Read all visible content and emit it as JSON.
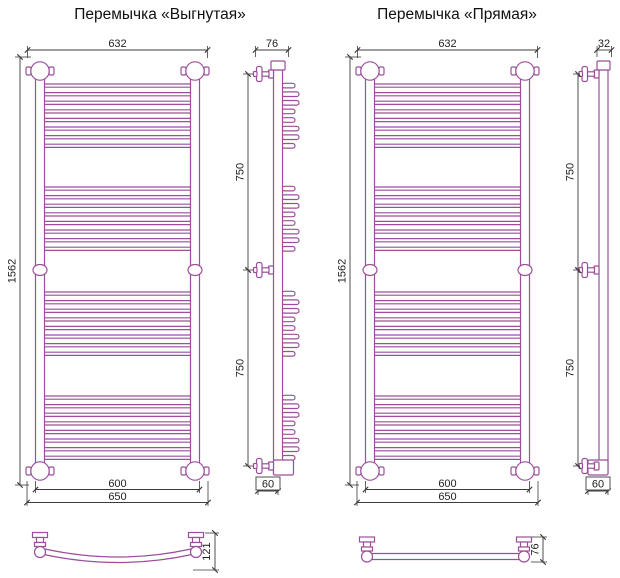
{
  "colors": {
    "product_line": "#9B4F9B",
    "dimension_line": "#3C3C3C",
    "text": "#222222"
  },
  "views": {
    "curved": {
      "title": "Перемычка «Выгнутая»",
      "front": {
        "width_top": "632",
        "height": "1562",
        "mount_span": "600",
        "overall_width": "650"
      },
      "side": {
        "depth_top": "76",
        "upper_span": "750",
        "lower_span": "750",
        "bracket_offset": "60"
      },
      "plan": {
        "depth": "121"
      }
    },
    "straight": {
      "title": "Перемычка «Прямая»",
      "front": {
        "width_top": "632",
        "height": "1562",
        "mount_span": "600",
        "overall_width": "650"
      },
      "side": {
        "depth_top": "32",
        "upper_span": "750",
        "lower_span": "750",
        "bracket_offset": "60"
      },
      "plan": {
        "depth": "76"
      }
    }
  }
}
